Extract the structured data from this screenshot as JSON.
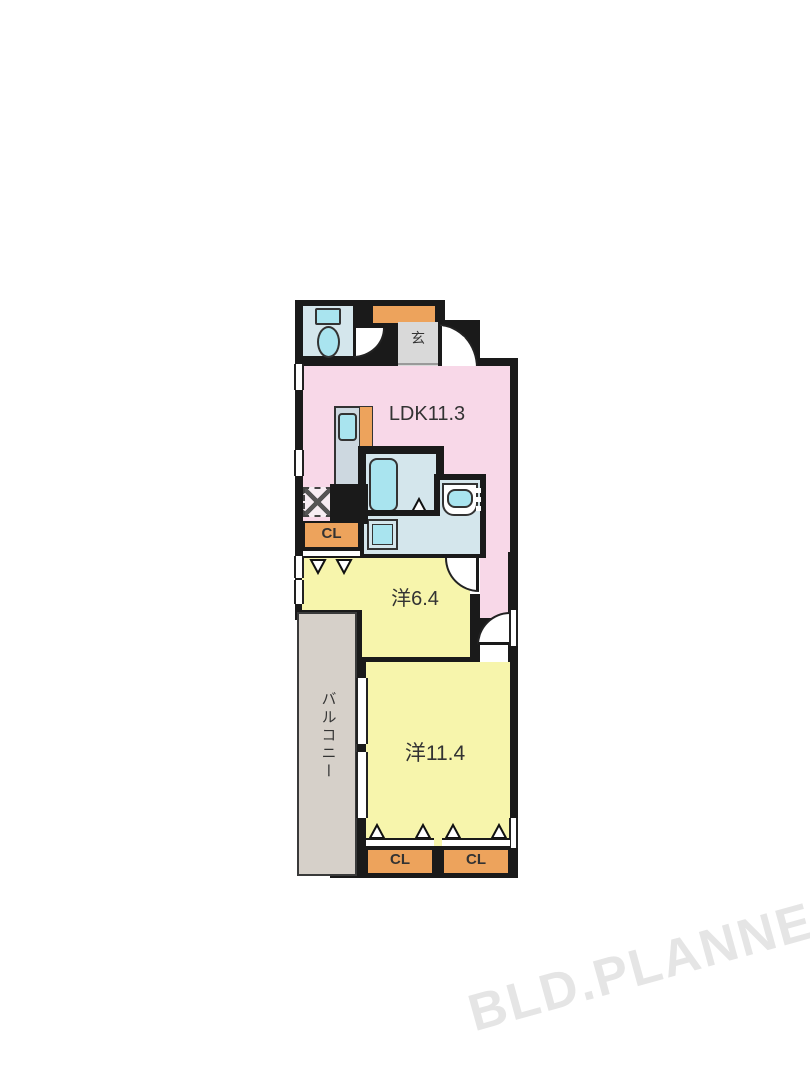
{
  "floorplan": {
    "rooms": {
      "ldk": {
        "label": "LDK11.3"
      },
      "entrance": {
        "label": "玄"
      },
      "western_6_4": {
        "label": "洋6.4"
      },
      "western_11_4": {
        "label": "洋11.4"
      },
      "balcony": {
        "label": "バルコニー"
      },
      "closet_mid": {
        "label": "CL"
      },
      "closet_bottom_left": {
        "label": "CL"
      },
      "closet_bottom_right": {
        "label": "CL"
      }
    },
    "watermark": "BLD.PLANNER",
    "colors": {
      "wall": "#1a1a1a",
      "pink": "#f8d8e8",
      "yellow": "#f7f5ac",
      "orange": "#eda35c",
      "room-blue": "#d4e6ec",
      "fixture-cyan": "#a9e4ef",
      "gray": "#d9d9d9",
      "balcony": "#d6d0c9",
      "watermark": "#e5e5e5",
      "text": "#333333"
    }
  }
}
